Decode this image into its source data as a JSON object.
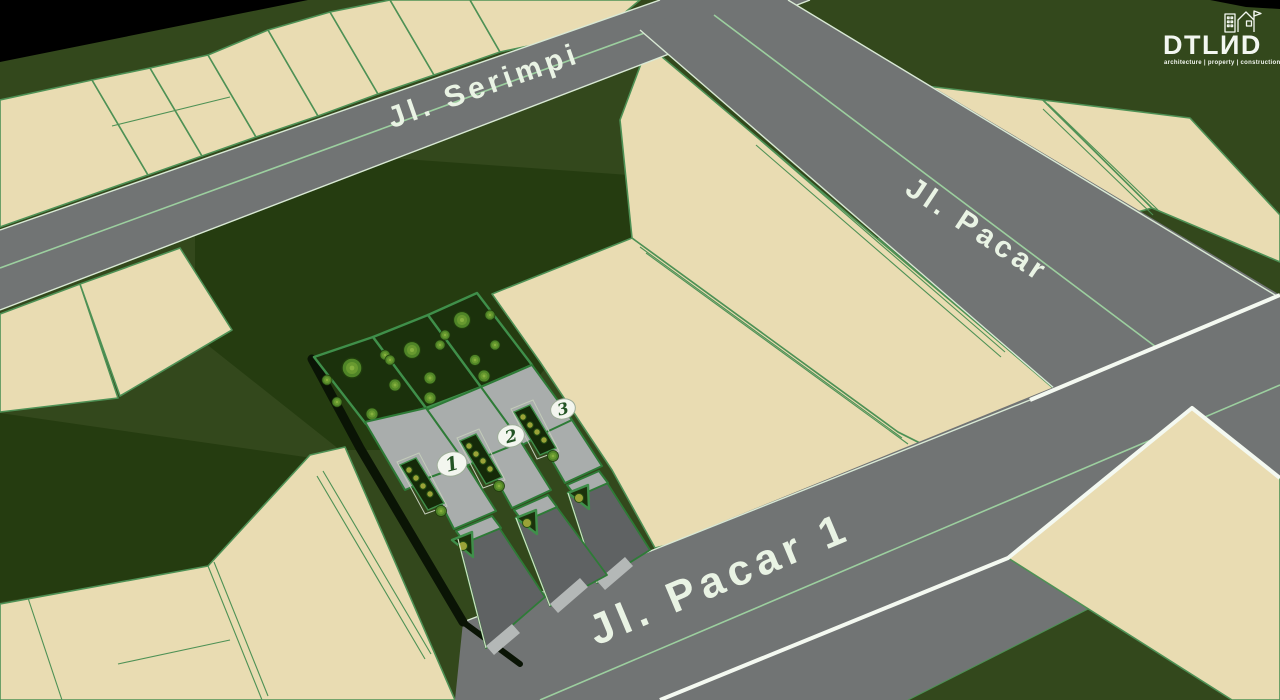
{
  "colors": {
    "void": "#000000",
    "grass": "#33481c",
    "grassDark": "#253c10",
    "parcel": "#e9dcb2",
    "parcelLine": "#4e9155",
    "road": "#717474",
    "roadEdge": "#d9e9d5",
    "roadCenter": "#9ccf9f",
    "whiteLine": "#f4f9f1",
    "siteGrass": "#1b310c",
    "stripFill": "#152a09",
    "fence": "#3f8f4a",
    "building": "#a9adac",
    "bldgLine": "#2e7b37",
    "driveway": "#5f6263",
    "tree": "#4f8427",
    "treeRing": "#1f3c0c",
    "treeInner": "#68992f",
    "treeDot": "#86b13f",
    "plant": "#9aa238",
    "plantRing": "#275013",
    "shadow": "#0a1405",
    "badgeFill": "#f3f6ef",
    "badgeText": "#235324",
    "label": "#e9f3e4",
    "logo": "#f3f7f1"
  },
  "streets": [
    {
      "name": "Jl. Serimpi"
    },
    {
      "name": "Jl. Pacar"
    },
    {
      "name": "Jl. Pacar 1"
    }
  ],
  "site": {
    "units": [
      {
        "number": "1"
      },
      {
        "number": "2"
      },
      {
        "number": "3"
      }
    ]
  },
  "logo": {
    "wordmark": "DTLИD",
    "tagline": "architecture | property | construction"
  }
}
